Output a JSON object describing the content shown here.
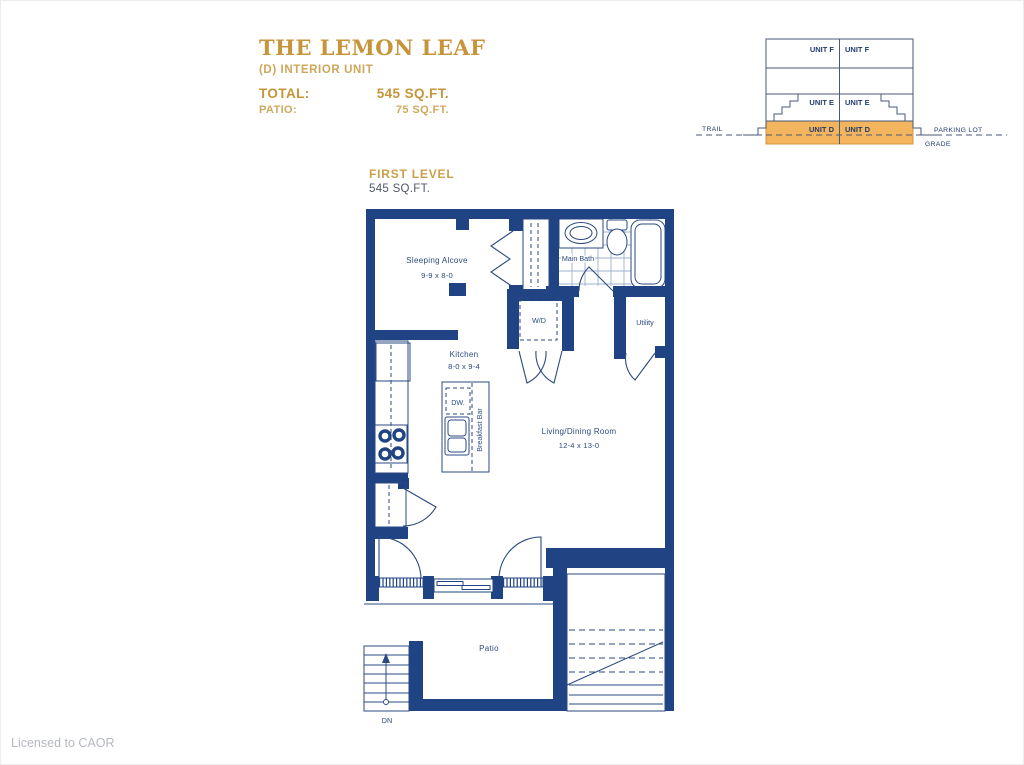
{
  "page": {
    "license": "Licensed to CAOR"
  },
  "title_block": {
    "name": "THE LEMON LEAF",
    "subtitle": "(D) INTERIOR UNIT",
    "total_label": "TOTAL:",
    "total_value": "545 SQ.FT.",
    "patio_label": "PATIO:",
    "patio_value": "75 SQ.FT."
  },
  "level": {
    "label": "FIRST LEVEL",
    "area": "545 SQ.FT."
  },
  "cross_section": {
    "unit_f": "UNIT F",
    "unit_e": "UNIT E",
    "unit_d": "UNIT D",
    "trail": "TRAIL",
    "parking_lot": "PARKING LOT",
    "grade": "GRADE"
  },
  "rooms": {
    "sleeping_alcove": {
      "name": "Sleeping Alcove",
      "dims": "9-9 x 8-0"
    },
    "main_bath": {
      "name": "Main Bath"
    },
    "wd": {
      "name": "W/D"
    },
    "utility": {
      "name": "Utility"
    },
    "kitchen": {
      "name": "Kitchen",
      "dims": "8-0 x 9-4"
    },
    "living_dining": {
      "name": "Living/Dining Room",
      "dims": "12-4 x 13-0"
    },
    "patio": {
      "name": "Patio"
    },
    "dishwasher": {
      "name": "DW."
    },
    "breakfast_bar": {
      "name": "Breakfast Bar"
    },
    "stairs_down": {
      "name": "DN"
    }
  },
  "colors": {
    "wall_navy": "#1f4383",
    "label_navy": "#2b4a80",
    "accent_gold": "#c6953b",
    "accent_gold_light": "#cfa95c",
    "unit_highlight_orange": "#f2b45c",
    "license_gray": "#b5b9bf"
  }
}
